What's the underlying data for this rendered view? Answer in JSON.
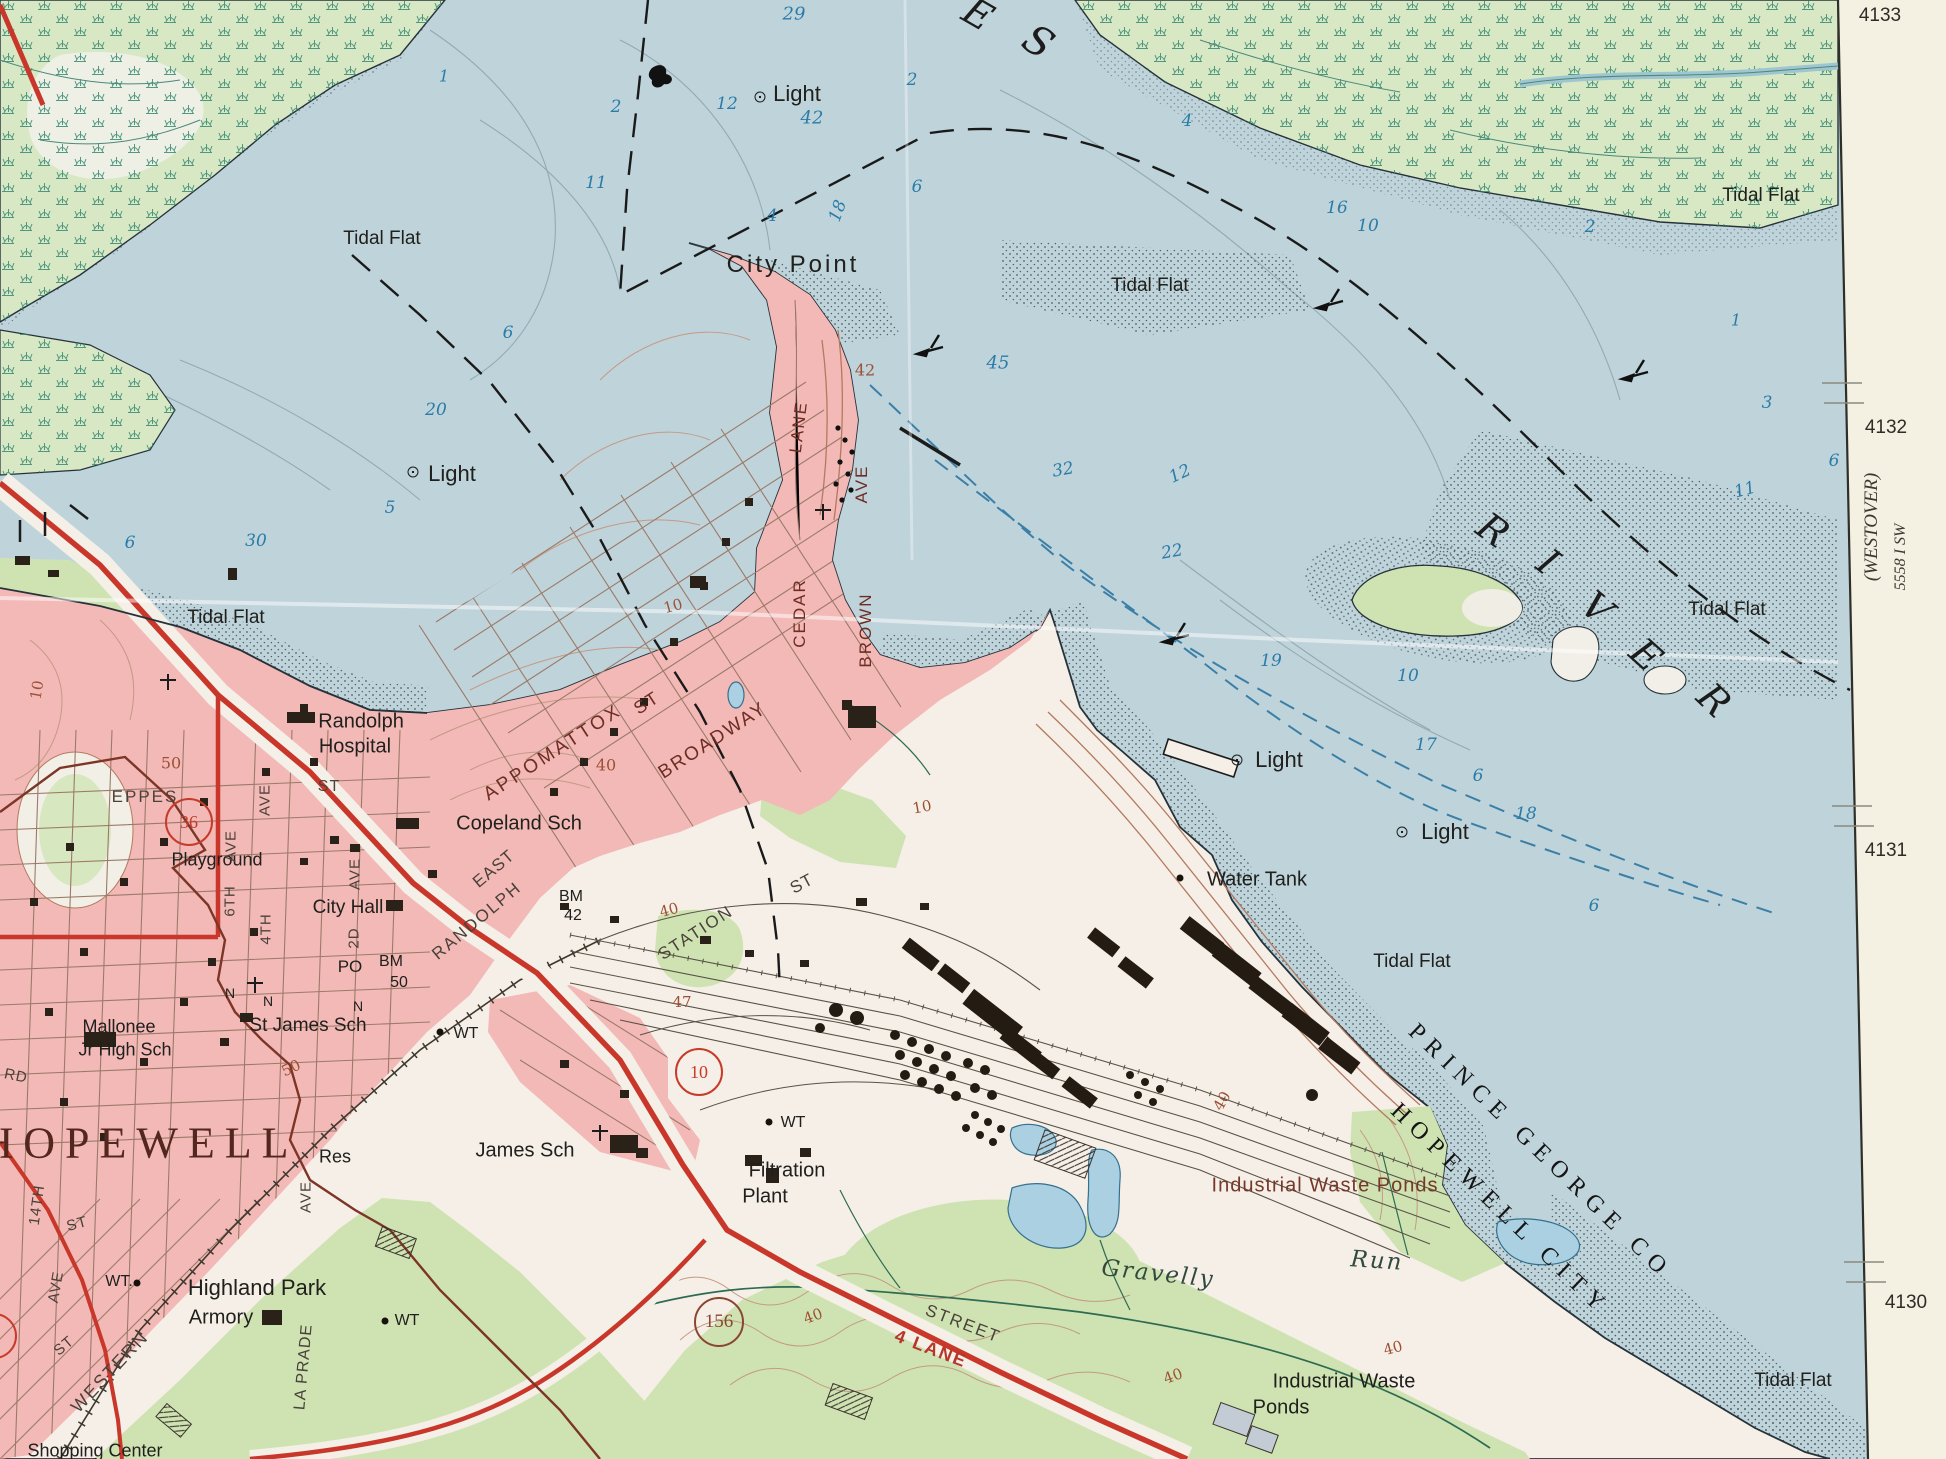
{
  "map": {
    "type": "usgs-topographic-quadrangle-photo",
    "area": "Hopewell / City Point, James River",
    "colors": {
      "water": "#bfd3da",
      "urban_pink": "#f3b9b7",
      "marsh_green": "#d9e8c4",
      "woodland_green": "#cfe3b2",
      "land_white": "#f5efe7",
      "road_red": "#c8372a",
      "contour_brown": "#b4795f",
      "boundary_maroon": "#7c3526",
      "margin_cream": "#f4f0e2",
      "depth_blue": "#2a7ca8"
    },
    "margin_notes": {
      "adjoining_quad": "(WESTOVER)",
      "series_number": "5558 I SW"
    },
    "grid_numbers": [
      "4133",
      "4132",
      "4131",
      "4130"
    ],
    "route_shields": [
      {
        "n": "10",
        "x": 699,
        "y": 1072,
        "c": "#c63b2a",
        "d": 44
      },
      {
        "n": "156",
        "x": 719,
        "y": 1322,
        "c": "#8a4630",
        "d": 46
      },
      {
        "n": "36",
        "x": 189,
        "y": 822,
        "c": "#c63b2a",
        "d": 44
      },
      {
        "n": "",
        "x": -6,
        "y": 1336,
        "c": "#c63b2a",
        "d": 42
      }
    ],
    "lights": [
      {
        "x": 760,
        "y": 97
      },
      {
        "x": 413,
        "y": 472
      },
      {
        "x": 1237,
        "y": 760
      },
      {
        "x": 1402,
        "y": 832
      }
    ],
    "dots": [
      {
        "x": 1180,
        "y": 878
      },
      {
        "x": 440,
        "y": 1032
      },
      {
        "x": 769,
        "y": 1122
      },
      {
        "x": 385,
        "y": 1321
      },
      {
        "x": 137,
        "y": 1283
      }
    ],
    "labels": [
      {
        "t": "City Point",
        "x": 793,
        "y": 265,
        "s": 24,
        "k": "place",
        "ls": 3
      },
      {
        "t": "Light",
        "x": 797,
        "y": 94,
        "s": 22,
        "k": "place"
      },
      {
        "t": "Light",
        "x": 452,
        "y": 474,
        "s": 22,
        "k": "place"
      },
      {
        "t": "Light",
        "x": 1279,
        "y": 760,
        "s": 22,
        "k": "place"
      },
      {
        "t": "Light",
        "x": 1445,
        "y": 832,
        "s": 22,
        "k": "place"
      },
      {
        "t": "Tidal Flat",
        "x": 382,
        "y": 239,
        "s": 19,
        "k": "place"
      },
      {
        "t": "Tidal Flat",
        "x": 1150,
        "y": 286,
        "s": 19,
        "k": "place"
      },
      {
        "t": "Tidal Flat",
        "x": 1761,
        "y": 196,
        "s": 19,
        "k": "place"
      },
      {
        "t": "Tidal Flat",
        "x": 1727,
        "y": 610,
        "s": 19,
        "k": "place"
      },
      {
        "t": "Tidal Flat",
        "x": 226,
        "y": 618,
        "s": 19,
        "k": "place"
      },
      {
        "t": "Tidal Flat",
        "x": 1412,
        "y": 962,
        "s": 19,
        "k": "place"
      },
      {
        "t": "Tidal Flat",
        "x": 1793,
        "y": 1381,
        "s": 19,
        "k": "place"
      },
      {
        "t": "Water Tank",
        "x": 1257,
        "y": 880,
        "s": 20,
        "k": "place"
      },
      {
        "t": "Randolph",
        "x": 361,
        "y": 722,
        "s": 20,
        "k": "place"
      },
      {
        "t": "Hospital",
        "x": 355,
        "y": 747,
        "s": 20,
        "k": "place"
      },
      {
        "t": "Copeland Sch",
        "x": 519,
        "y": 824,
        "s": 20,
        "k": "place"
      },
      {
        "t": "City Hall",
        "x": 348,
        "y": 908,
        "s": 19,
        "k": "place"
      },
      {
        "t": "St James Sch",
        "x": 308,
        "y": 1026,
        "s": 19,
        "k": "place"
      },
      {
        "t": "Mallonee",
        "x": 119,
        "y": 1027,
        "s": 18,
        "k": "place"
      },
      {
        "t": "Jr High Sch",
        "x": 125,
        "y": 1050,
        "s": 18,
        "k": "place"
      },
      {
        "t": "James Sch",
        "x": 525,
        "y": 1151,
        "s": 20,
        "k": "place"
      },
      {
        "t": "Filtration",
        "x": 787,
        "y": 1171,
        "s": 20,
        "k": "place"
      },
      {
        "t": "Plant",
        "x": 765,
        "y": 1197,
        "s": 20,
        "k": "place"
      },
      {
        "t": "Highland Park",
        "x": 257,
        "y": 1288,
        "s": 22,
        "k": "place"
      },
      {
        "t": "Armory",
        "x": 221,
        "y": 1318,
        "s": 20,
        "k": "place"
      },
      {
        "t": "Res",
        "x": 335,
        "y": 1157,
        "s": 18,
        "k": "place"
      },
      {
        "t": "Playground",
        "x": 217,
        "y": 860,
        "s": 18,
        "k": "place"
      },
      {
        "t": "Shopping Center",
        "x": 95,
        "y": 1451,
        "s": 18,
        "k": "place"
      },
      {
        "t": "Water Tank",
        "x": 0,
        "y": -100,
        "s": 1,
        "k": "place"
      },
      {
        "t": "WT",
        "x": 466,
        "y": 1034,
        "s": 16,
        "k": "place"
      },
      {
        "t": "WT",
        "x": 793,
        "y": 1123,
        "s": 16,
        "k": "place"
      },
      {
        "t": "WT",
        "x": 407,
        "y": 1321,
        "s": 16,
        "k": "place"
      },
      {
        "t": "WT.",
        "x": 119,
        "y": 1282,
        "s": 16,
        "k": "place"
      },
      {
        "t": "PO",
        "x": 350,
        "y": 967,
        "s": 17,
        "k": "place"
      },
      {
        "t": "BM",
        "x": 391,
        "y": 962,
        "s": 16,
        "k": "place"
      },
      {
        "t": "50",
        "x": 399,
        "y": 983,
        "s": 16,
        "k": "place"
      },
      {
        "t": "BM",
        "x": 571,
        "y": 897,
        "s": 16,
        "k": "place"
      },
      {
        "t": "42",
        "x": 573,
        "y": 916,
        "s": 16,
        "k": "place"
      },
      {
        "t": "N",
        "x": 230,
        "y": 993,
        "s": 14,
        "k": "place"
      },
      {
        "t": "N",
        "x": 268,
        "y": 1001,
        "s": 14,
        "k": "place"
      },
      {
        "t": "N",
        "x": 358,
        "y": 1006,
        "s": 14,
        "k": "place"
      },
      {
        "t": "Industrial Waste Ponds",
        "x": 1325,
        "y": 1186,
        "s": 20,
        "k": "brown",
        "ls": 1
      },
      {
        "t": "Industrial Waste",
        "x": 1344,
        "y": 1382,
        "s": 20,
        "k": "place"
      },
      {
        "t": "Ponds",
        "x": 1281,
        "y": 1408,
        "s": 20,
        "k": "place"
      },
      {
        "t": "HOPEWELL",
        "x": 140,
        "y": 1143,
        "s": 44,
        "k": "big",
        "ls": 10
      },
      {
        "t": "Gravelly",
        "x": 1158,
        "y": 1274,
        "s": 23,
        "k": "stream",
        "r": 6,
        "ls": 2
      },
      {
        "t": "Run",
        "x": 1377,
        "y": 1261,
        "s": 23,
        "k": "stream",
        "r": 4,
        "ls": 2
      },
      {
        "t": "PRINCE GEORGE CO",
        "x": 1540,
        "y": 1152,
        "s": 24,
        "k": "bound",
        "r": 44,
        "ls": 8
      },
      {
        "t": "HOPEWELL CITY",
        "x": 1500,
        "y": 1210,
        "s": 24,
        "k": "bound",
        "r": 44,
        "ls": 8
      },
      {
        "t": "E",
        "x": 978,
        "y": 14,
        "s": 38,
        "k": "river",
        "r": 30
      },
      {
        "t": "S",
        "x": 1038,
        "y": 42,
        "s": 40,
        "k": "river",
        "r": 33
      },
      {
        "t": "R",
        "x": 1493,
        "y": 530,
        "s": 38,
        "k": "river",
        "r": 36
      },
      {
        "t": "I",
        "x": 1548,
        "y": 562,
        "s": 38,
        "k": "river",
        "r": 38
      },
      {
        "t": "V",
        "x": 1597,
        "y": 608,
        "s": 38,
        "k": "river",
        "r": 40
      },
      {
        "t": "E",
        "x": 1646,
        "y": 655,
        "s": 38,
        "k": "river",
        "r": 42
      },
      {
        "t": "R",
        "x": 1714,
        "y": 700,
        "s": 38,
        "k": "river",
        "r": 44
      },
      {
        "t": "APPOMATTOX",
        "x": 553,
        "y": 753,
        "s": 19,
        "k": "streetA",
        "r": -33,
        "ls": 3
      },
      {
        "t": "ST",
        "x": 647,
        "y": 703,
        "s": 18,
        "k": "streetA",
        "r": -33
      },
      {
        "t": "BROADWAY",
        "x": 713,
        "y": 741,
        "s": 19,
        "k": "streetA",
        "r": -33,
        "ls": 2
      },
      {
        "t": "CEDAR",
        "x": 800,
        "y": 613,
        "s": 17,
        "k": "streetA",
        "r": -90
      },
      {
        "t": "LANE",
        "x": 799,
        "y": 427,
        "s": 17,
        "k": "streetA",
        "r": -83
      },
      {
        "t": "BROWN",
        "x": 866,
        "y": 630,
        "s": 17,
        "k": "streetA",
        "r": -90
      },
      {
        "t": "AVE",
        "x": 862,
        "y": 484,
        "s": 17,
        "k": "streetA",
        "r": -90
      },
      {
        "t": "EAST",
        "x": 494,
        "y": 869,
        "s": 17,
        "k": "streetB",
        "r": -40
      },
      {
        "t": "RANDOLPH",
        "x": 477,
        "y": 921,
        "s": 17,
        "k": "streetB",
        "r": -40,
        "ls": 2
      },
      {
        "t": "STATION",
        "x": 696,
        "y": 933,
        "s": 17,
        "k": "streetB",
        "r": -33,
        "ls": 2
      },
      {
        "t": "ST",
        "x": 802,
        "y": 884,
        "s": 17,
        "k": "streetB",
        "r": -28
      },
      {
        "t": "EPPES",
        "x": 145,
        "y": 797,
        "s": 17,
        "k": "streetB",
        "ls": 2
      },
      {
        "t": "6TH",
        "x": 230,
        "y": 901,
        "s": 15,
        "k": "streetB",
        "r": -90
      },
      {
        "t": "AVE",
        "x": 231,
        "y": 846,
        "s": 15,
        "k": "streetB",
        "r": -90
      },
      {
        "t": "4TH",
        "x": 266,
        "y": 929,
        "s": 15,
        "k": "streetB",
        "r": -90
      },
      {
        "t": "AVE",
        "x": 265,
        "y": 800,
        "s": 15,
        "k": "streetB",
        "r": -90
      },
      {
        "t": "2D",
        "x": 354,
        "y": 938,
        "s": 15,
        "k": "streetB",
        "r": -90
      },
      {
        "t": "AVE",
        "x": 355,
        "y": 874,
        "s": 15,
        "k": "streetB",
        "r": -90
      },
      {
        "t": "ST",
        "x": 329,
        "y": 787,
        "s": 16,
        "k": "streetB"
      },
      {
        "t": "14TH",
        "x": 37,
        "y": 1205,
        "s": 15,
        "k": "streetB",
        "r": -82
      },
      {
        "t": "ST",
        "x": 77,
        "y": 1224,
        "s": 15,
        "k": "streetB",
        "r": -15
      },
      {
        "t": "AVE",
        "x": 306,
        "y": 1197,
        "s": 15,
        "k": "streetB",
        "r": -90
      },
      {
        "t": "RD",
        "x": 16,
        "y": 1076,
        "s": 15,
        "k": "streetB",
        "r": 12
      },
      {
        "t": "WESTERN",
        "x": 110,
        "y": 1372,
        "s": 18,
        "k": "streetB",
        "r": -47,
        "ls": 2
      },
      {
        "t": "ST",
        "x": 64,
        "y": 1346,
        "s": 15,
        "k": "streetB",
        "r": -40
      },
      {
        "t": "AVE",
        "x": 56,
        "y": 1287,
        "s": 15,
        "k": "streetB",
        "r": -80
      },
      {
        "t": "LA PRADE",
        "x": 304,
        "y": 1367,
        "s": 16,
        "k": "streetB",
        "r": -85,
        "ls": 1
      },
      {
        "t": "STREET",
        "x": 963,
        "y": 1324,
        "s": 17,
        "k": "streetB",
        "r": 21,
        "ls": 2
      },
      {
        "t": "4 LANE",
        "x": 931,
        "y": 1349,
        "s": 18,
        "k": "red",
        "r": 21
      },
      {
        "t": "50",
        "x": 171,
        "y": 763,
        "s": 16,
        "k": "contour"
      },
      {
        "t": "50",
        "x": 291,
        "y": 1068,
        "s": 15,
        "k": "contour",
        "r": -25
      },
      {
        "t": "40",
        "x": 606,
        "y": 765,
        "s": 16,
        "k": "contour"
      },
      {
        "t": "42",
        "x": 865,
        "y": 370,
        "s": 16,
        "k": "contour"
      },
      {
        "t": "10",
        "x": 673,
        "y": 606,
        "s": 15,
        "k": "contour",
        "r": -15
      },
      {
        "t": "10",
        "x": 922,
        "y": 807,
        "s": 15,
        "k": "contour",
        "r": -10
      },
      {
        "t": "40",
        "x": 669,
        "y": 910,
        "s": 15,
        "k": "contour",
        "r": -15
      },
      {
        "t": "47",
        "x": 682,
        "y": 1002,
        "s": 15,
        "k": "contour"
      },
      {
        "t": "40",
        "x": 813,
        "y": 1316,
        "s": 15,
        "k": "contour",
        "r": -20
      },
      {
        "t": "40",
        "x": 1222,
        "y": 1101,
        "s": 15,
        "k": "contour",
        "r": -60
      },
      {
        "t": "40",
        "x": 1173,
        "y": 1376,
        "s": 15,
        "k": "contour",
        "r": -20
      },
      {
        "t": "40",
        "x": 1393,
        "y": 1348,
        "s": 15,
        "k": "contour",
        "r": -15
      },
      {
        "t": "10",
        "x": 37,
        "y": 690,
        "s": 15,
        "k": "contour",
        "r": -80
      },
      {
        "t": "1",
        "x": 444,
        "y": 76,
        "s": 16,
        "k": "water"
      },
      {
        "t": "29",
        "x": 794,
        "y": 14,
        "s": 18,
        "k": "water"
      },
      {
        "t": "2",
        "x": 616,
        "y": 107,
        "s": 17,
        "k": "water"
      },
      {
        "t": "12",
        "x": 727,
        "y": 104,
        "s": 17,
        "k": "water"
      },
      {
        "t": "42",
        "x": 812,
        "y": 118,
        "s": 18,
        "k": "water"
      },
      {
        "t": "2",
        "x": 912,
        "y": 80,
        "s": 17,
        "k": "water"
      },
      {
        "t": "11",
        "x": 596,
        "y": 183,
        "s": 17,
        "k": "water"
      },
      {
        "t": "4",
        "x": 772,
        "y": 216,
        "s": 17,
        "k": "water"
      },
      {
        "t": "18",
        "x": 838,
        "y": 211,
        "s": 17,
        "k": "water",
        "r": -70
      },
      {
        "t": "6",
        "x": 917,
        "y": 187,
        "s": 17,
        "k": "water"
      },
      {
        "t": "4",
        "x": 1187,
        "y": 121,
        "s": 17,
        "k": "water"
      },
      {
        "t": "16",
        "x": 1337,
        "y": 208,
        "s": 17,
        "k": "water"
      },
      {
        "t": "10",
        "x": 1368,
        "y": 226,
        "s": 17,
        "k": "water"
      },
      {
        "t": "2",
        "x": 1590,
        "y": 227,
        "s": 17,
        "k": "water"
      },
      {
        "t": "1",
        "x": 1736,
        "y": 320,
        "s": 16,
        "k": "water"
      },
      {
        "t": "3",
        "x": 1767,
        "y": 403,
        "s": 17,
        "k": "water"
      },
      {
        "t": "6",
        "x": 1834,
        "y": 461,
        "s": 17,
        "k": "water"
      },
      {
        "t": "11",
        "x": 1745,
        "y": 490,
        "s": 17,
        "k": "water",
        "r": -15
      },
      {
        "t": "6",
        "x": 508,
        "y": 333,
        "s": 17,
        "k": "water"
      },
      {
        "t": "20",
        "x": 436,
        "y": 410,
        "s": 17,
        "k": "water"
      },
      {
        "t": "5",
        "x": 390,
        "y": 508,
        "s": 17,
        "k": "water"
      },
      {
        "t": "6",
        "x": 130,
        "y": 543,
        "s": 17,
        "k": "water"
      },
      {
        "t": "30",
        "x": 256,
        "y": 541,
        "s": 17,
        "k": "water"
      },
      {
        "t": "45",
        "x": 998,
        "y": 363,
        "s": 18,
        "k": "water"
      },
      {
        "t": "32",
        "x": 1063,
        "y": 470,
        "s": 17,
        "k": "water",
        "r": -10
      },
      {
        "t": "12",
        "x": 1180,
        "y": 474,
        "s": 17,
        "k": "water",
        "r": -25
      },
      {
        "t": "22",
        "x": 1172,
        "y": 552,
        "s": 17,
        "k": "water",
        "r": -10
      },
      {
        "t": "19",
        "x": 1271,
        "y": 661,
        "s": 17,
        "k": "water"
      },
      {
        "t": "10",
        "x": 1408,
        "y": 676,
        "s": 17,
        "k": "water"
      },
      {
        "t": "17",
        "x": 1426,
        "y": 745,
        "s": 17,
        "k": "water"
      },
      {
        "t": "6",
        "x": 1478,
        "y": 776,
        "s": 17,
        "k": "water"
      },
      {
        "t": "18",
        "x": 1526,
        "y": 814,
        "s": 17,
        "k": "water"
      },
      {
        "t": "6",
        "x": 1594,
        "y": 906,
        "s": 17,
        "k": "water"
      },
      {
        "t": "4133",
        "x": 1880,
        "y": 16,
        "s": 19,
        "k": "margin"
      },
      {
        "t": "4132",
        "x": 1886,
        "y": 428,
        "s": 19,
        "k": "margin"
      },
      {
        "t": "4131",
        "x": 1886,
        "y": 851,
        "s": 19,
        "k": "margin"
      },
      {
        "t": "4130",
        "x": 1906,
        "y": 1303,
        "s": 19,
        "k": "margin"
      },
      {
        "t": "(WESTOVER)",
        "x": 1872,
        "y": 527,
        "s": 19,
        "k": "marginI",
        "r": -90
      },
      {
        "t": "5558 I SW",
        "x": 1901,
        "y": 557,
        "s": 16,
        "k": "marginI",
        "r": -90
      }
    ]
  }
}
